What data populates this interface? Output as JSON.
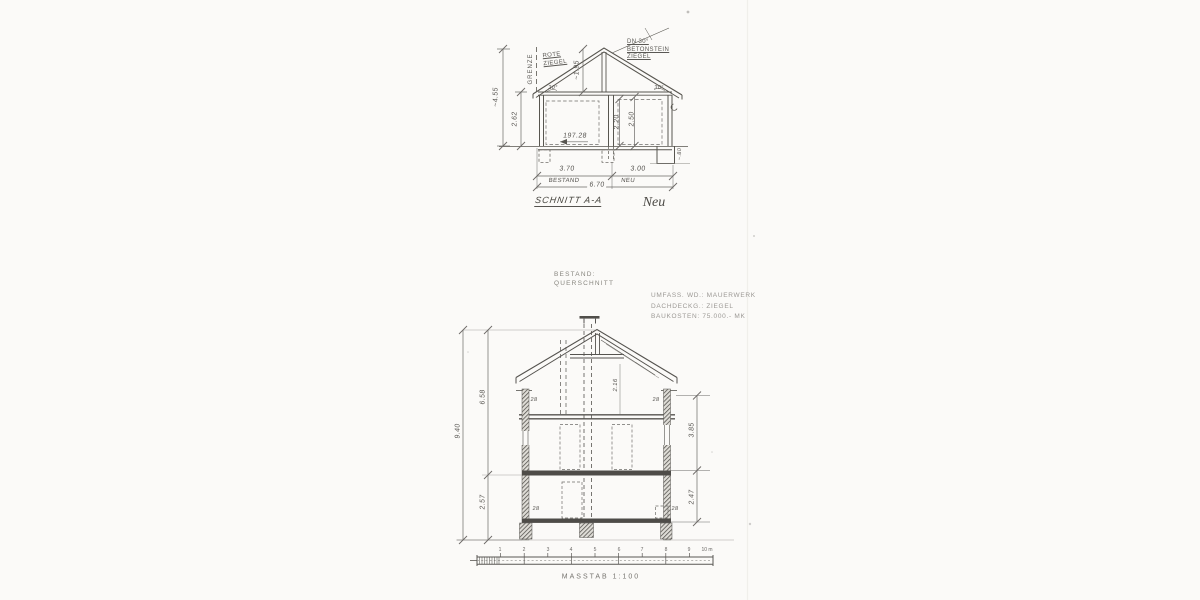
{
  "top_drawing": {
    "title": "SCHNITT A-A",
    "hand_note": "Neu",
    "boundary_label": "GRENZE",
    "roof_material": {
      "line1": "ROTE",
      "line2": "ZIEGEL"
    },
    "roof_note": {
      "line1": "DN 30°",
      "line2": "BETONSTEIN",
      "line3": "ZIEGEL"
    },
    "level_mark": "197.28",
    "angle_left": "30°",
    "angle_right": "30°",
    "dims": {
      "total_height": "~4.55",
      "wall_height": "2.62",
      "ridge_height": "~1.95",
      "room_left_height": "2.20",
      "room_right_height": "2.50",
      "step_right": "~.80",
      "width_bestand": "3.70",
      "width_neu": "3.00",
      "width_total": "6.70"
    },
    "width_labels": {
      "bestand": "BESTAND",
      "neu": "NEU"
    }
  },
  "heading": {
    "line1": "BESTAND:",
    "line2": "QUERSCHNITT"
  },
  "notes": {
    "line1": "UMFASS. WD.: MAUERWERK",
    "line2": "DACHDECKG.: ZIEGEL",
    "line3": "BAUKOSTEN: 75.000.- MK"
  },
  "bottom_drawing": {
    "dims": {
      "total_height": "9.40",
      "upper_height": "6.58",
      "ground_height": "2.57",
      "right_upper": "3.85",
      "right_lower": "2.47",
      "attic_room": "2.16",
      "wall_thickness": "28"
    }
  },
  "scale_bar": {
    "ticks": [
      "1",
      "2",
      "3",
      "4",
      "5",
      "6",
      "7",
      "8",
      "9",
      "10 m"
    ],
    "caption": "MASSTAB 1:100"
  }
}
